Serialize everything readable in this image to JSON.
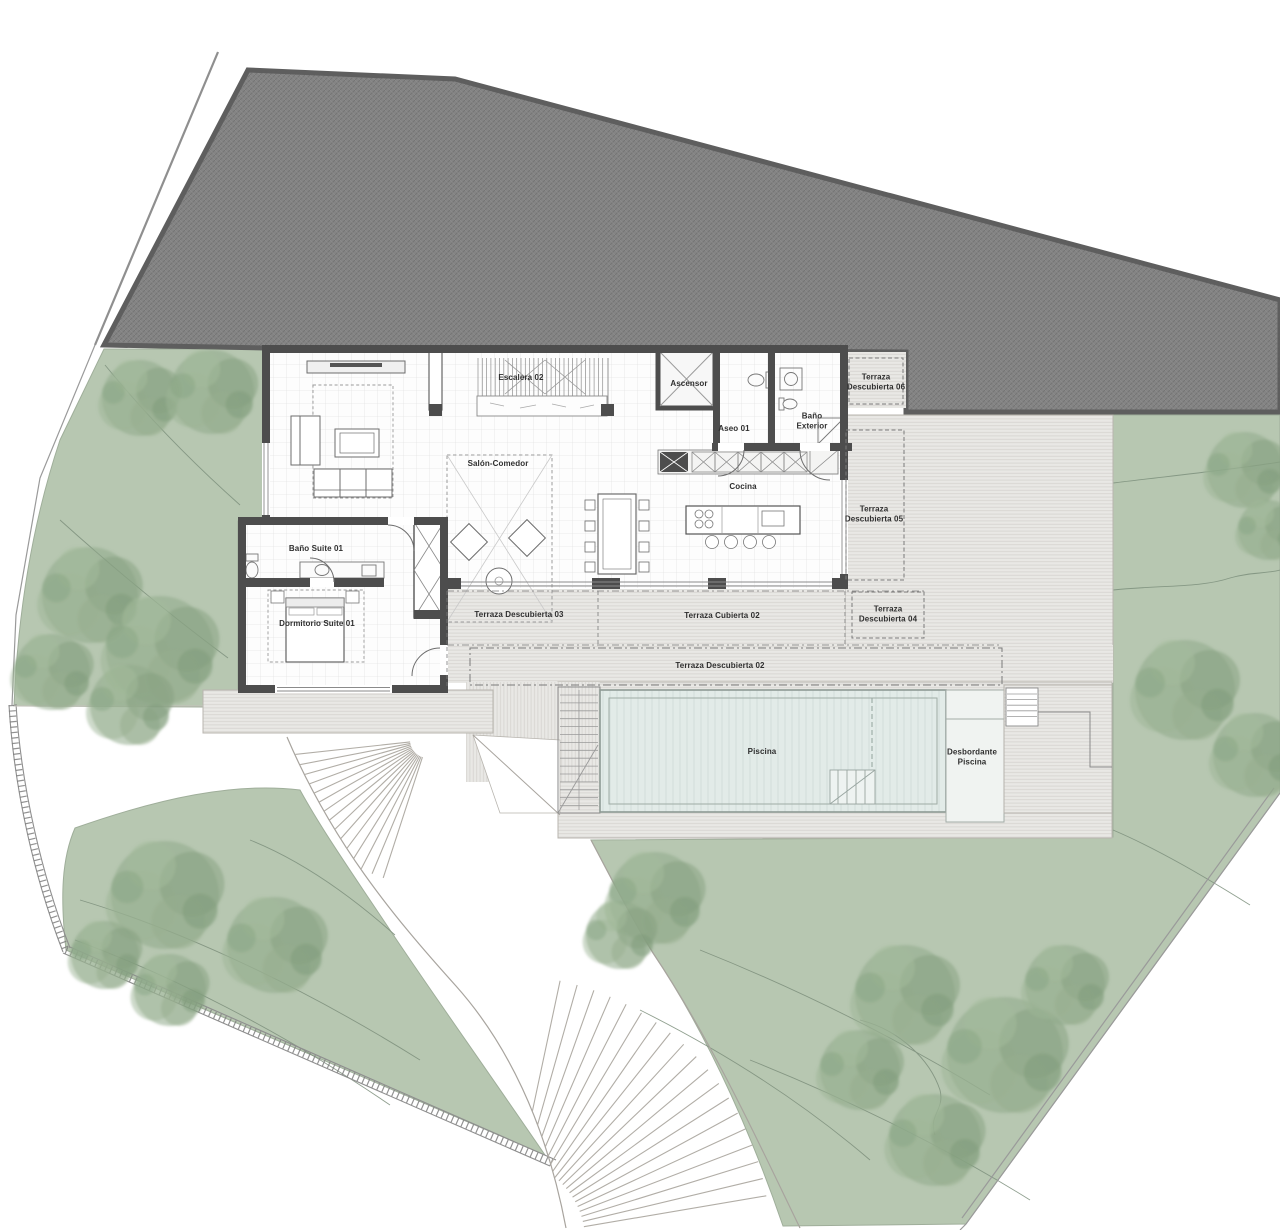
{
  "plan": {
    "labels": [
      {
        "id": "escalera-02",
        "text": "Escalera 02",
        "x": 521,
        "y": 378,
        "w": 70
      },
      {
        "id": "ascensor",
        "text": "Ascensor",
        "x": 689,
        "y": 384,
        "w": 60
      },
      {
        "id": "aseo-01",
        "text": "Aseo 01",
        "x": 734,
        "y": 429,
        "w": 50
      },
      {
        "id": "bano-exterior",
        "text": "Baño Exterior",
        "x": 812,
        "y": 421,
        "w": 46
      },
      {
        "id": "salon-comedor",
        "text": "Salón-Comedor",
        "x": 498,
        "y": 464,
        "w": 100
      },
      {
        "id": "cocina",
        "text": "Cocina",
        "x": 743,
        "y": 487,
        "w": 60
      },
      {
        "id": "bano-suite-01",
        "text": "Baño Suite 01",
        "x": 316,
        "y": 549,
        "w": 95
      },
      {
        "id": "dormitorio-suite-01",
        "text": "Dormitorio Suite 01",
        "x": 317,
        "y": 624,
        "w": 130
      },
      {
        "id": "terraza-descubierta-06",
        "text": "Terraza Descubierta 06",
        "x": 876,
        "y": 382,
        "w": 60
      },
      {
        "id": "terraza-descubierta-05",
        "text": "Terraza Descubierta 05",
        "x": 874,
        "y": 514,
        "w": 60
      },
      {
        "id": "terraza-descubierta-04",
        "text": "Terraza Descubierta 04",
        "x": 888,
        "y": 614,
        "w": 60
      },
      {
        "id": "terraza-descubierta-03",
        "text": "Terraza Descubierta 03",
        "x": 519,
        "y": 615,
        "w": 150
      },
      {
        "id": "terraza-cubierta-02",
        "text": "Terraza Cubierta 02",
        "x": 722,
        "y": 616,
        "w": 140
      },
      {
        "id": "terraza-descubierta-02",
        "text": "Terraza Descubierta 02",
        "x": 720,
        "y": 666,
        "w": 170
      },
      {
        "id": "piscina",
        "text": "Piscina",
        "x": 762,
        "y": 752,
        "w": 60
      },
      {
        "id": "desbordante-piscina",
        "text": "Desbordante Piscina",
        "x": 972,
        "y": 757,
        "w": 64
      }
    ],
    "colors": {
      "garden_green": "#b7c7b1",
      "tree_green": "#8faa8a",
      "road_gray": "#848484",
      "road_border": "#5e5e5e",
      "deck_gray": "#e9e8e5",
      "wall_dark": "#4d4d4d",
      "pool_water": "#e2ebe8",
      "label_ink": "#2f2f2f"
    }
  }
}
